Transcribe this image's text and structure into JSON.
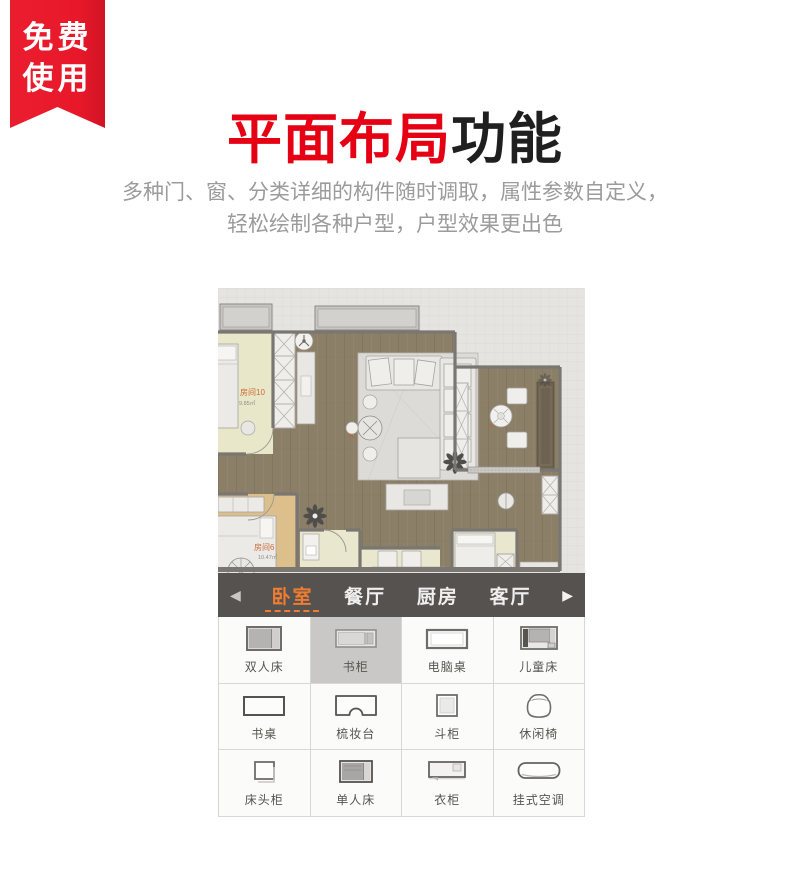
{
  "badge": {
    "line1": "免费",
    "line2": "使用",
    "bg_color": "#e8192b"
  },
  "header": {
    "title_highlight": "平面布局",
    "title_rest": "功能",
    "highlight_color": "#e60014",
    "subtitle_line1": "多种门、窗、分类详细的构件随时调取，属性参数自定义，",
    "subtitle_line2": "轻松绘制各种户型，户型效果更出色"
  },
  "floorplan": {
    "rooms": [
      {
        "name": "房间10",
        "area": "9.85㎡"
      },
      {
        "name": "房间6",
        "area": "10.47㎡"
      }
    ]
  },
  "category_bar": {
    "prev_arrow": "◀",
    "next_arrow": "▶",
    "bg_color": "#565250",
    "active_color": "#ee7c31",
    "tabs": [
      {
        "label": "卧室",
        "active": true
      },
      {
        "label": "餐厅",
        "active": false
      },
      {
        "label": "厨房",
        "active": false
      },
      {
        "label": "客厅",
        "active": false
      }
    ]
  },
  "furniture_panel": {
    "items": [
      {
        "label": "双人床",
        "icon": "double-bed-icon",
        "selected": false
      },
      {
        "label": "书柜",
        "icon": "bookcase-icon",
        "selected": true
      },
      {
        "label": "电脑桌",
        "icon": "computer-desk-icon",
        "selected": false
      },
      {
        "label": "儿童床",
        "icon": "kids-bed-icon",
        "selected": false
      },
      {
        "label": "书桌",
        "icon": "desk-icon",
        "selected": false
      },
      {
        "label": "梳妆台",
        "icon": "dressing-table-icon",
        "selected": false
      },
      {
        "label": "斗柜",
        "icon": "chest-icon",
        "selected": false
      },
      {
        "label": "休闲椅",
        "icon": "lounge-chair-icon",
        "selected": false
      },
      {
        "label": "床头柜",
        "icon": "nightstand-icon",
        "selected": false
      },
      {
        "label": "单人床",
        "icon": "single-bed-icon",
        "selected": false
      },
      {
        "label": "衣柜",
        "icon": "wardrobe-icon",
        "selected": false
      },
      {
        "label": "挂式空调",
        "icon": "wall-ac-icon",
        "selected": false
      }
    ]
  }
}
